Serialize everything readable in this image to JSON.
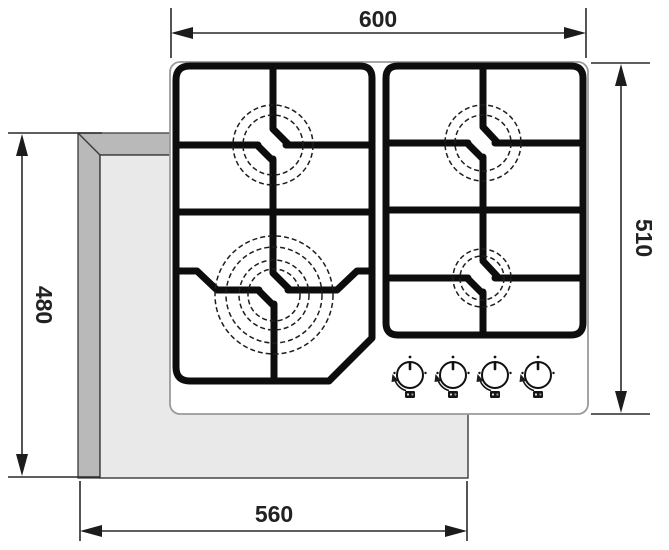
{
  "drawing": {
    "title": "gas-hob-installation-dimensions-diagram",
    "dimensions": {
      "top_width": "600",
      "right_height": "510",
      "left_height": "480",
      "bottom_width": "560"
    },
    "burners": [
      {
        "name": "top-left-burner",
        "size": "medium"
      },
      {
        "name": "top-right-burner",
        "size": "medium"
      },
      {
        "name": "bottom-left-burner",
        "size": "large"
      },
      {
        "name": "bottom-right-burner",
        "size": "small"
      }
    ],
    "knob_count": 4,
    "colors": {
      "line": "#1c1c1c",
      "grate": "#0d0d0d",
      "countertop_edge": "#b9b9b9",
      "countertop_surface": "#e9e9e9",
      "hob_surface": "#ffffff"
    }
  }
}
